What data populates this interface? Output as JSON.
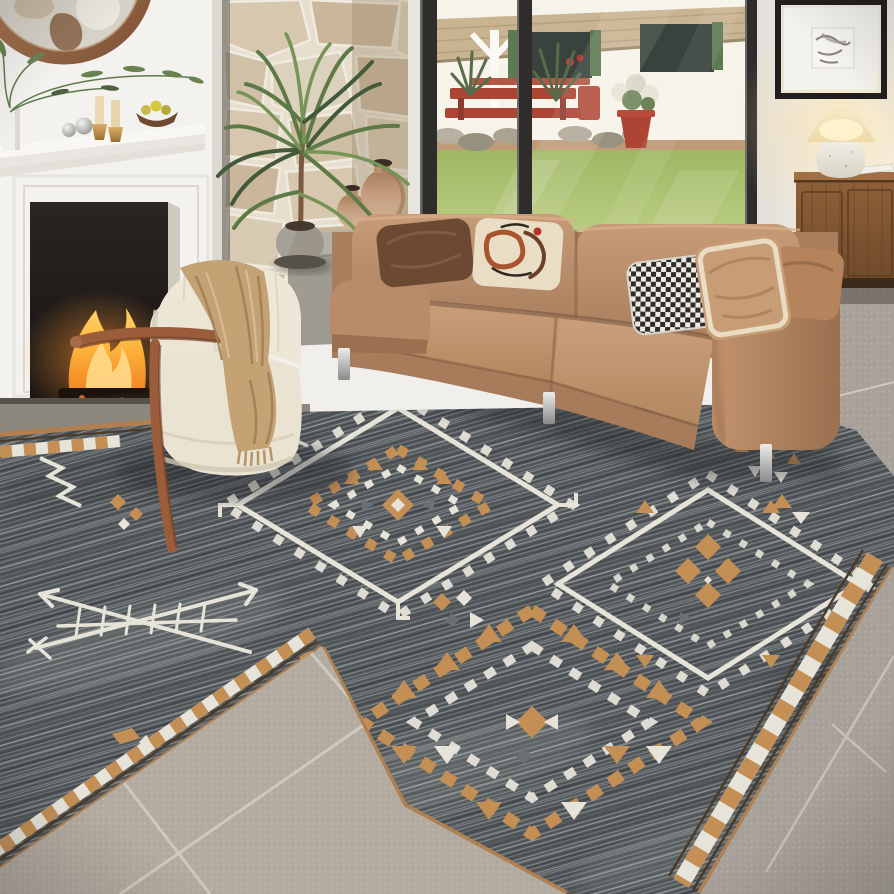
{
  "meta": {
    "type": "photograph",
    "subject": "living room staged with a southwestern geometric area rug",
    "width": 894,
    "height": 894
  },
  "palette": {
    "wall": "#f1efeb",
    "chimney": "#f3f2ef",
    "mantel_top": "#f8f7f4",
    "mantel_front": "#e9e6e1",
    "firebox_dark": "#221d1a",
    "fire_orange": "#f5922c",
    "fire_yellow": "#ffc75e",
    "stone_base": "#e7decd",
    "stone_1": "#d6c7ae",
    "stone_2": "#c9b69b",
    "stone_3": "#dcd1bc",
    "mirror_copper": "#a9744d",
    "mirror_glass": "#d7d2c8",
    "frame_black": "#211f1d",
    "art_mat": "#f4f2ed",
    "lamp_base": "#edeae1",
    "lamp_shade": "#f6e8c4",
    "sideboard_wood": "#8a5c38",
    "sideboard_plinth": "#3c2a1a",
    "house_white": "#f6f3ea",
    "roof_thatch": "#c9b491",
    "window_dark": "#39423c",
    "shutter_green": "#5d7a53",
    "outdoor_red": "#ad4534",
    "dirt": "#c09a78",
    "lawn_far": "#a3bb66",
    "lawn_near": "#d6e4a3",
    "sofa_leather": "#bb8f6c",
    "sofa_leather_light": "#cca180",
    "sofa_leather_dark": "#97704f",
    "pillow_darkbrown": "#6b4933",
    "pillow_cream": "#e9ddc6",
    "pillow_rust": "#a8542f",
    "hound_dark": "#2e2b28",
    "hound_light": "#eceae3",
    "pillow_tan": "#c79d75",
    "pillow_trim": "#e9dcc2",
    "pillow_caramel": "#b5835c",
    "chair_cream": "#eee7d8",
    "chair_shade": "#d8cfbc",
    "wood_arm": "#9a5c3b",
    "blanket_tan": "#c4a274",
    "blanket_fold": "#9f7e55",
    "ledge_concrete": "#b5b0a6",
    "vase_terracotta": "#c29b79",
    "pot_concrete": "#9b958a",
    "trunk_brown": "#7a5a40",
    "plant_green": "#5d7a46",
    "plant_green_dark": "#42593a",
    "plant_green_light": "#779457",
    "rug_base": "#565b5f",
    "rug_ivory": "#e6e3d9",
    "rug_camel": "#c48f55",
    "rug_slate": "#6a7076",
    "rug_binding": "#b08050",
    "rug_border_line": "#4a3a28",
    "tile_light": "#b3aba0",
    "tile_right": "#a8a199",
    "tile_dark_strip": "#8d887e",
    "tile_grout": "#d5cec2",
    "chrome": "#d9d9d9"
  },
  "scene": {
    "left_wall": {
      "mirror": {
        "shape": "round",
        "frame": "copper"
      },
      "fireplace": {
        "state": "lit",
        "surround": "white"
      },
      "mantel_items": [
        "white vase with green branches",
        "two silver spheres",
        "two cream candles on brass holders",
        "wood bowl with pears"
      ]
    },
    "stone_column": {
      "material": "stacked natural stone"
    },
    "glass_doors": {
      "frame": "black",
      "panes": 2,
      "view": {
        "house": "white cottage with pergola roof",
        "shuttered_windows": 2,
        "furniture": "red picnic table and benches",
        "planter": "red pot with white flowers",
        "ground": [
          "rock bed",
          "sunlit lawn"
        ]
      }
    },
    "right_wall": {
      "artwork": "small abstract print in black frame",
      "lamp": {
        "state": "on",
        "base": "white ceramic",
        "shade": "cream"
      },
      "sideboard": "walnut wood",
      "magazine": "white"
    },
    "sofa": {
      "upholstery": "caramel leather",
      "legs": "chrome",
      "pillows": [
        "chocolate leather",
        "cream abstract print",
        "black and white houndstooth",
        "tan leather with cream trim",
        "caramel leather"
      ]
    },
    "armchair": {
      "upholstery": "cream boucle",
      "frame": "bent walnut arm",
      "blanket": "camel fringed throw"
    },
    "accessories": {
      "terracotta_vases": 2,
      "potted_plant": "palm in round concrete pot"
    },
    "rug": {
      "field": "heathered charcoal gray",
      "motifs": [
        "stepped diamond medallion left",
        "stepped diamond medallion right",
        "sawtooth triangle diamond bottom",
        "crossed arrow sticks",
        "greek key zigzags",
        "small diamond clusters"
      ],
      "accents": [
        "ivory",
        "camel"
      ],
      "border": "camel and ivory checkered diamonds with espresso pinstripes"
    },
    "floor": {
      "material": "gray stone tile"
    }
  }
}
